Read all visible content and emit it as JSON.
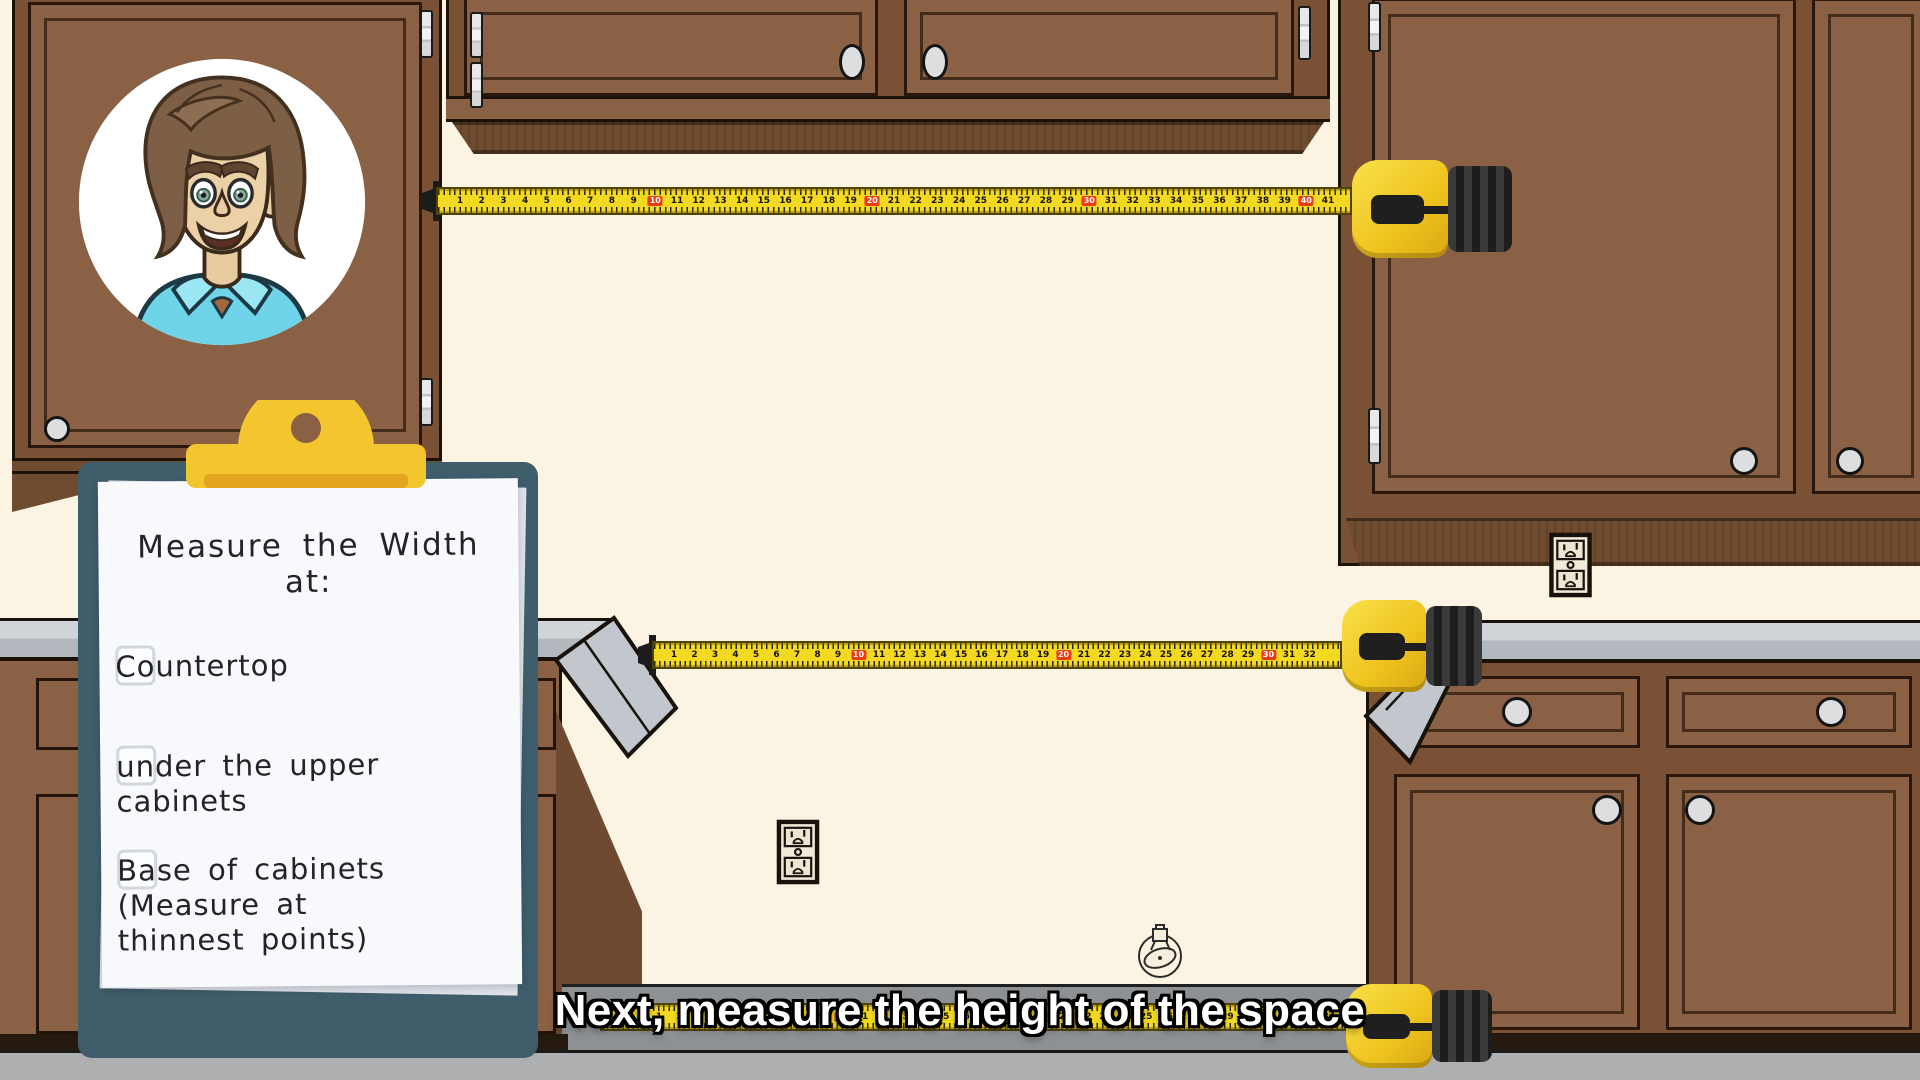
{
  "caption": {
    "text": "Next, measure the height of the space"
  },
  "clipboard": {
    "title": "Measure the Width\nat:",
    "items": [
      {
        "label": "Countertop",
        "checked": false
      },
      {
        "label": "under the upper\ncabinets",
        "checked": false
      },
      {
        "label": "Base of cabinets\n(Measure at\nthinnest points)",
        "checked": false
      }
    ]
  },
  "tapes": [
    {
      "name": "upper-wall-tape-scale",
      "start": 1,
      "end": 41,
      "red_every": 10
    },
    {
      "name": "countertop-tape-scale",
      "start": 1,
      "end": 32,
      "red_every": 10
    },
    {
      "name": "floor-tape-scale",
      "start": 1,
      "end": 34,
      "red_every": 10
    }
  ],
  "colors": {
    "wall": "#fbf4e2",
    "cabinet_face": "#8a6144",
    "cabinet_frame": "#7b5136",
    "outline": "#1d1207",
    "countertop": "#c6cbd0",
    "floor": "#adafb1",
    "clipboard_board": "#3f5d6b",
    "clip_yellow": "#f3c52e",
    "tape_yellow": "#f4d922",
    "tape_red_marker": "#ee3a12",
    "caption_text": "#ffffff",
    "caption_outline": "#000000",
    "avatar_shirt": "#6fd4e8"
  }
}
